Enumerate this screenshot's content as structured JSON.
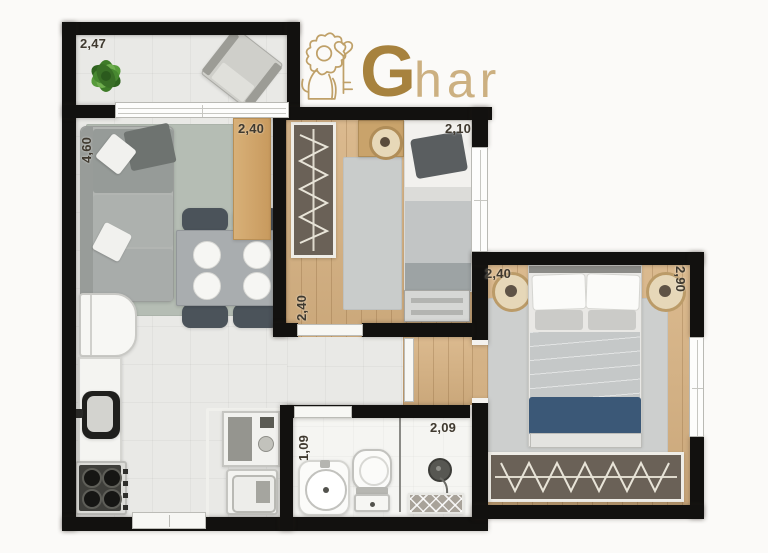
{
  "logo": {
    "brand_initial": "G",
    "brand_rest": "har",
    "icon": "lion-with-key-crest",
    "gold": "#a7823e",
    "gold_light": "#ccb081"
  },
  "dims": {
    "balcony_width": "2,47",
    "living_length": "4,60",
    "sideboard_width": "2,40",
    "bedroom1_width": "2,10",
    "bedroom1_length": "2,40",
    "bedroom2_width": "2,40",
    "bedroom2_length": "2,90",
    "bathroom_width": "1,09",
    "bathroom_length": "2,09"
  },
  "palette": {
    "wall": "#12110f",
    "wood": "#d7b282",
    "tile": "#e9e9e6",
    "bath": "#f5f5f2",
    "rug_living": "#b5bdb4",
    "rug_gray": "#c9cccb",
    "navy": "#3b5877",
    "gold": "#a7823e",
    "gold_light": "#ccb081",
    "plant_green": "#4e8c33"
  },
  "furniture_inventory": [
    "plant",
    "armchair",
    "sofa",
    "living-rug",
    "dining-table",
    "dining-chairs",
    "sideboard",
    "fridge",
    "kitchen-counter",
    "kitchen-sink",
    "stove",
    "washing-machine",
    "laundry-tub",
    "bathroom-sink",
    "toilet",
    "shower",
    "bath-mat",
    "wardrobe-bedroom1",
    "single-bed",
    "trundle-drawer",
    "round-stool",
    "bedroom1-rug",
    "double-bed",
    "bedroom2-rug",
    "poufs",
    "wardrobe-bedroom2"
  ]
}
